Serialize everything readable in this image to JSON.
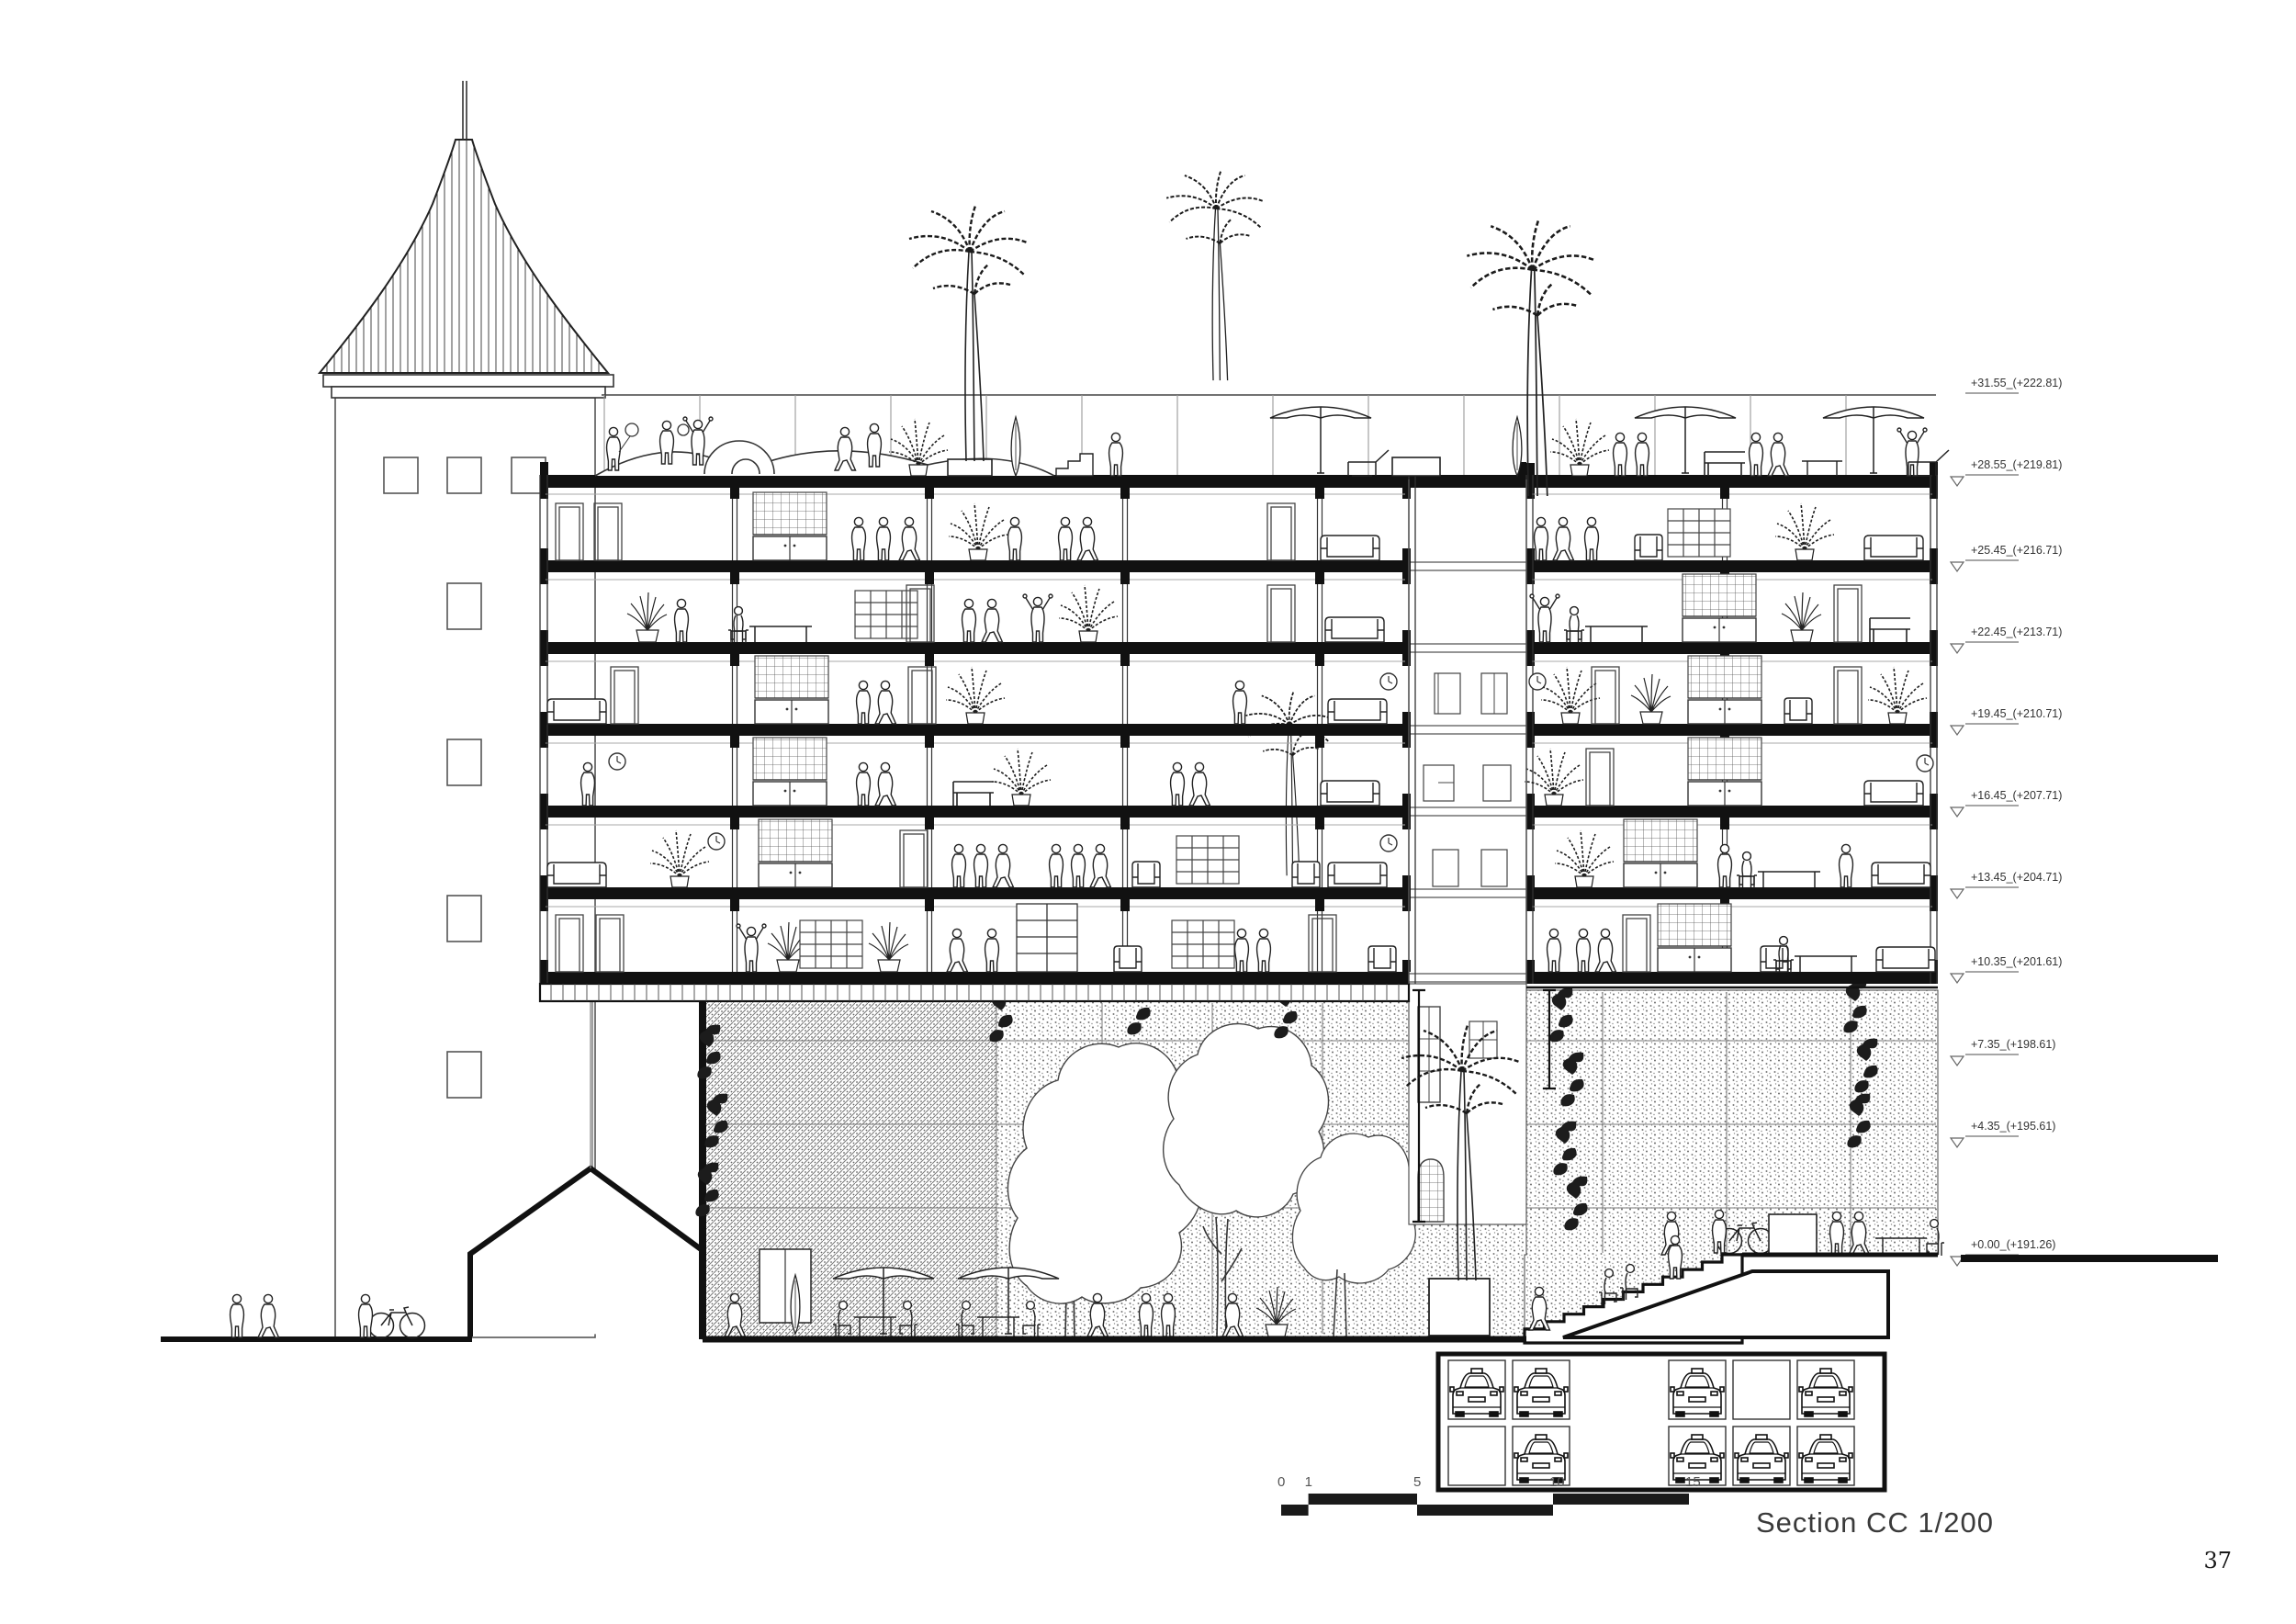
{
  "sheet": {
    "title": "Section CC 1/200",
    "page_number": "37"
  },
  "elevation_markers": [
    {
      "label": "+31.55_(+222.81)",
      "meters": 31.55,
      "kind": "railing"
    },
    {
      "label": "+28.55_(+219.81)",
      "meters": 28.55,
      "kind": "slab"
    },
    {
      "label": "+25.45_(+216.71)",
      "meters": 25.45,
      "kind": "slab"
    },
    {
      "label": "+22.45_(+213.71)",
      "meters": 22.45,
      "kind": "slab"
    },
    {
      "label": "+19.45_(+210.71)",
      "meters": 19.45,
      "kind": "slab"
    },
    {
      "label": "+16.45_(+207.71)",
      "meters": 16.45,
      "kind": "slab"
    },
    {
      "label": "+13.45_(+204.71)",
      "meters": 13.45,
      "kind": "slab"
    },
    {
      "label": "+10.35_(+201.61)",
      "meters": 10.35,
      "kind": "slab-bottom"
    },
    {
      "label": "+7.35_(+198.61)",
      "meters": 7.35,
      "kind": "level"
    },
    {
      "label": "+4.35_(+195.61)",
      "meters": 4.35,
      "kind": "level"
    },
    {
      "label": "+0.00_(+191.26)",
      "meters": 0.0,
      "kind": "ground"
    }
  ],
  "scale_bar": {
    "ticks": [
      0,
      1,
      5,
      10,
      15
    ]
  },
  "car_park": {
    "rows": [
      {
        "stalls": [
          true,
          true,
          true,
          false,
          true
        ]
      },
      {
        "stalls": [
          false,
          true,
          true,
          true,
          true
        ]
      }
    ]
  }
}
